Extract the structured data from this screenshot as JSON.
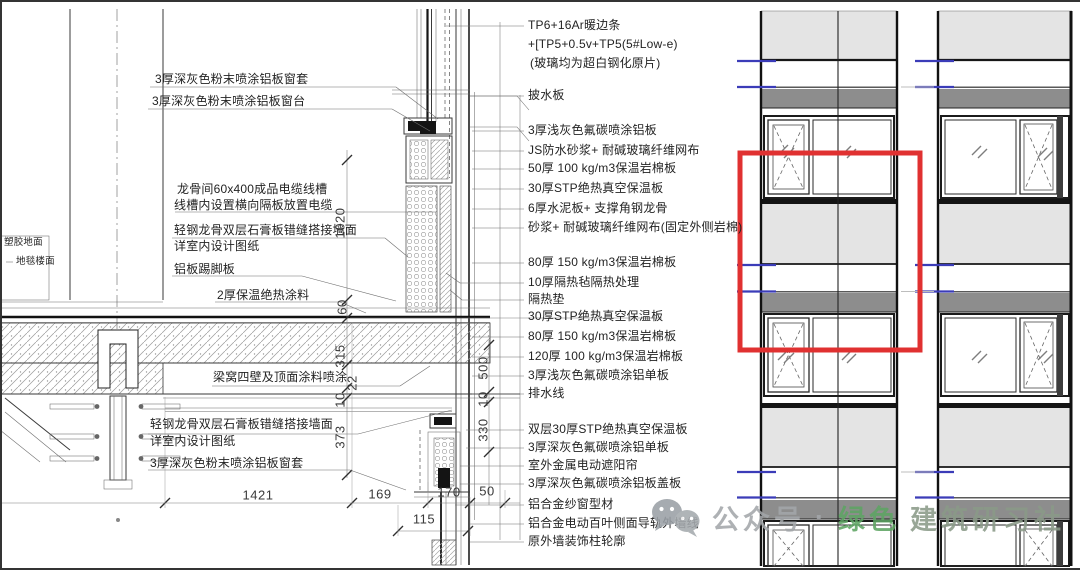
{
  "watermark": {
    "prefix": "公众号",
    "separator": "·",
    "brand_green": "绿色",
    "brand_rest": "建筑研习社"
  },
  "colors": {
    "highlight_red": "#e03131",
    "floor_line_blue": "#3b3cb8",
    "spandrel_gray": "#e4e4e4",
    "shadow_box_gray": "#8d8d8d",
    "watermark_gray": "#a3a7aa",
    "watermark_green": "#5ea463"
  },
  "annotations": {
    "right": [
      {
        "text": "TP6+16Ar暖边条",
        "x": 528,
        "y": 19
      },
      {
        "text": "+[TP5+0.5v+TP5(5#Low-e)",
        "x": 528,
        "y": 38
      },
      {
        "text": "(玻璃均为超白钢化原片)",
        "x": 530,
        "y": 57
      },
      {
        "text": "披水板",
        "x": 528,
        "y": 89
      },
      {
        "text": "3厚浅灰色氟碳喷涂铝板",
        "x": 528,
        "y": 124
      },
      {
        "text": "JS防水砂浆+ 耐碱玻璃纤维网布",
        "x": 528,
        "y": 144
      },
      {
        "text": "50厚 100 kg/m3保温岩棉板",
        "x": 528,
        "y": 162
      },
      {
        "text": "30厚STP绝热真空保温板",
        "x": 528,
        "y": 182
      },
      {
        "text": "6厚水泥板+ 支撑角钢龙骨",
        "x": 528,
        "y": 202
      },
      {
        "text": "砂浆+ 耐碱玻璃纤维网布(固定外侧岩棉)",
        "x": 528,
        "y": 221
      },
      {
        "text": "80厚 150 kg/m3保温岩棉板",
        "x": 528,
        "y": 256
      },
      {
        "text": "10厚隔热毡隔热处理",
        "x": 528,
        "y": 276
      },
      {
        "text": "隔热垫",
        "x": 528,
        "y": 293
      },
      {
        "text": "30厚STP绝热真空保温板",
        "x": 528,
        "y": 310
      },
      {
        "text": "80厚 150 kg/m3保温岩棉板",
        "x": 528,
        "y": 330
      },
      {
        "text": "120厚 100 kg/m3保温岩棉板",
        "x": 528,
        "y": 350
      },
      {
        "text": "3厚浅灰色氟碳喷涂铝单板",
        "x": 528,
        "y": 369
      },
      {
        "text": "排水线",
        "x": 528,
        "y": 387
      },
      {
        "text": "双层30厚STP绝热真空保温板",
        "x": 528,
        "y": 423
      },
      {
        "text": "3厚深灰色氟碳喷涂铝单板",
        "x": 528,
        "y": 441
      },
      {
        "text": "室外金属电动遮阳帘",
        "x": 528,
        "y": 459
      },
      {
        "text": "3厚深灰色氟碳喷涂铝板盖板",
        "x": 528,
        "y": 477
      },
      {
        "text": "铝合金纱窗型材",
        "x": 528,
        "y": 498
      },
      {
        "text": "铝合金电动百叶侧面导轨外墙线",
        "x": 528,
        "y": 517
      },
      {
        "text": "原外墙装饰柱轮廓",
        "x": 528,
        "y": 535
      }
    ],
    "left": [
      {
        "text": "3厚深灰色粉末喷涂铝板窗套",
        "x": 155,
        "y": 73
      },
      {
        "text": "3厚深灰色粉末喷涂铝板窗台",
        "x": 152,
        "y": 95
      },
      {
        "text": "龙骨间60x400成品电缆线槽",
        "x": 177,
        "y": 183
      },
      {
        "text": "线槽内设置横向隔板放置电缆",
        "x": 174,
        "y": 199
      },
      {
        "text": "轻钢龙骨双层石膏板错缝搭接墙面",
        "x": 174,
        "y": 224
      },
      {
        "text": "详室内设计图纸",
        "x": 174,
        "y": 240
      },
      {
        "text": "铝板踢脚板",
        "x": 174,
        "y": 263
      },
      {
        "text": "2厚保温绝热涂料",
        "x": 217,
        "y": 289
      },
      {
        "text": "梁窝四壁及顶面涂料喷涂",
        "x": 213,
        "y": 371
      },
      {
        "text": "轻钢龙骨双层石膏板错缝搭接墙面",
        "x": 150,
        "y": 418
      },
      {
        "text": "详室内设计图纸",
        "x": 150,
        "y": 435
      },
      {
        "text": "3厚深灰色粉末喷涂铝板窗套",
        "x": 150,
        "y": 457
      }
    ],
    "box": [
      {
        "text": "塑胶地面",
        "x": 4,
        "y": 238
      },
      {
        "text": "地毯楼面",
        "x": 16,
        "y": 257
      }
    ],
    "dims_v": [
      {
        "text": "1020",
        "x": 340,
        "y": 223
      },
      {
        "text": "60",
        "x": 342,
        "y": 307
      },
      {
        "text": "315",
        "x": 340,
        "y": 356
      },
      {
        "text": "22",
        "x": 352,
        "y": 383
      },
      {
        "text": "10",
        "x": 340,
        "y": 400
      },
      {
        "text": "373",
        "x": 340,
        "y": 437
      },
      {
        "text": "500",
        "x": 483,
        "y": 368
      },
      {
        "text": "10",
        "x": 483,
        "y": 399
      },
      {
        "text": "330",
        "x": 483,
        "y": 430
      }
    ],
    "dims_h": [
      {
        "text": "1421",
        "x": 258,
        "y": 495
      },
      {
        "text": "169",
        "x": 380,
        "y": 494
      },
      {
        "text": "170",
        "x": 449,
        "y": 492
      },
      {
        "text": "50",
        "x": 487,
        "y": 491
      },
      {
        "text": "115",
        "x": 424,
        "y": 519
      }
    ]
  }
}
